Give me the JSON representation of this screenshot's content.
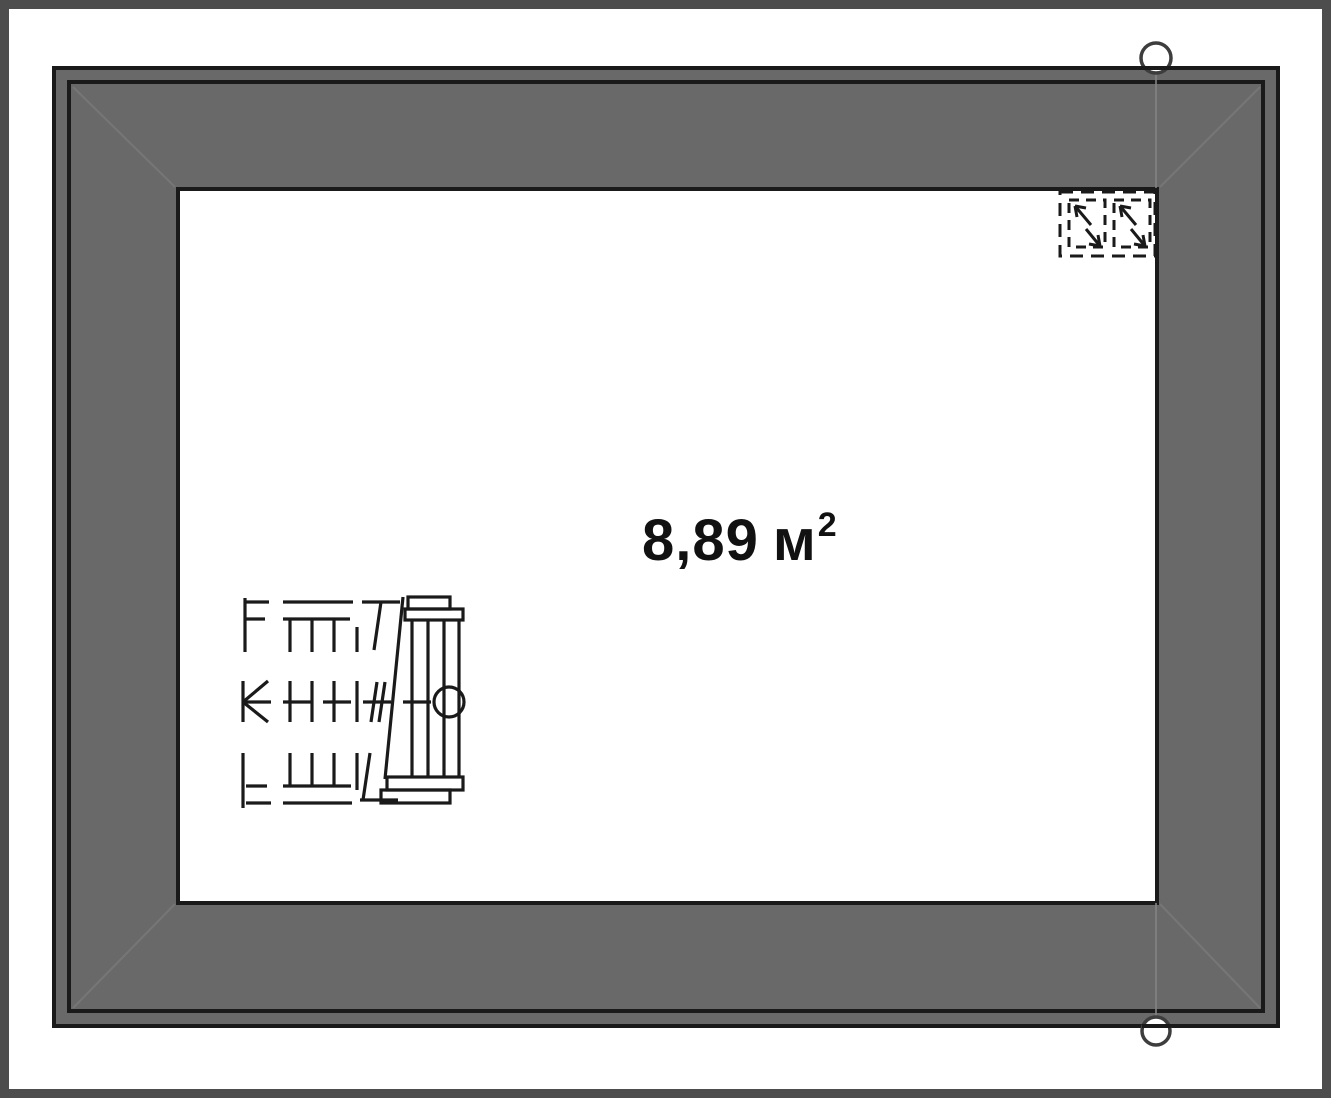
{
  "plan": {
    "room": {
      "area_value": "8,89",
      "area_unit": "м",
      "area_superscript": "2"
    },
    "symbols": {
      "roof_window": "roof-window-icon",
      "staircase": "staircase-icon",
      "section_marker_top": "section-marker-circle-top",
      "section_marker_bottom": "section-marker-circle-bottom",
      "hip_lines": "roof-hip-lines"
    },
    "colors": {
      "roof_fill": "#696969",
      "wall_line": "#1a1a1a",
      "page_border": "#4d4d4d",
      "paper": "#ffffff",
      "faint_line": "#828282"
    }
  }
}
